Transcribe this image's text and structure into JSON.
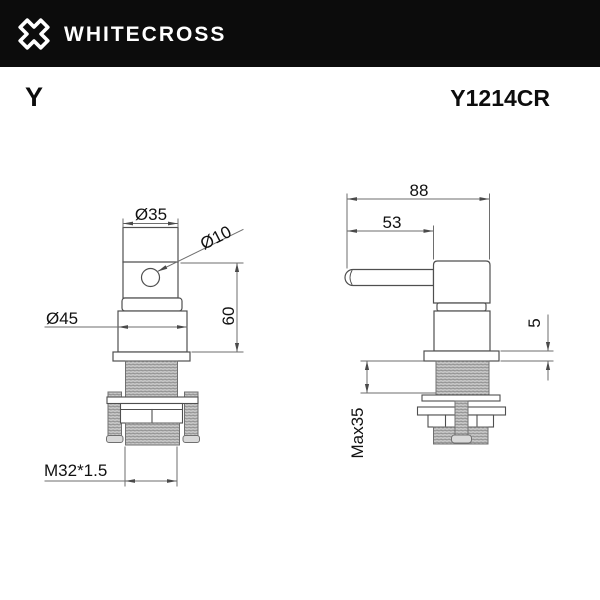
{
  "header": {
    "brand": "WHITECROSS"
  },
  "title_row": {
    "series": "Y",
    "model": "Y1214CR"
  },
  "drawing": {
    "front_view": {
      "dim_top_diameter": "Ø35",
      "dim_hole_diameter": "Ø10",
      "dim_base_diameter": "Ø45",
      "dim_height": "60",
      "dim_thread": "M32*1.5"
    },
    "side_view": {
      "dim_total_depth": "88",
      "dim_handle_length": "53",
      "dim_flange_thickness": "5",
      "dim_max_panel_thickness": "Max35"
    }
  },
  "colors": {
    "header_bg": "#0c0c0c",
    "outline": "#4f4f4f",
    "dimension_line": "#6e6e6e",
    "label_text": "#111111",
    "thread_fill": "#c6c6c6",
    "thread_stripe": "#8a8a8a"
  }
}
